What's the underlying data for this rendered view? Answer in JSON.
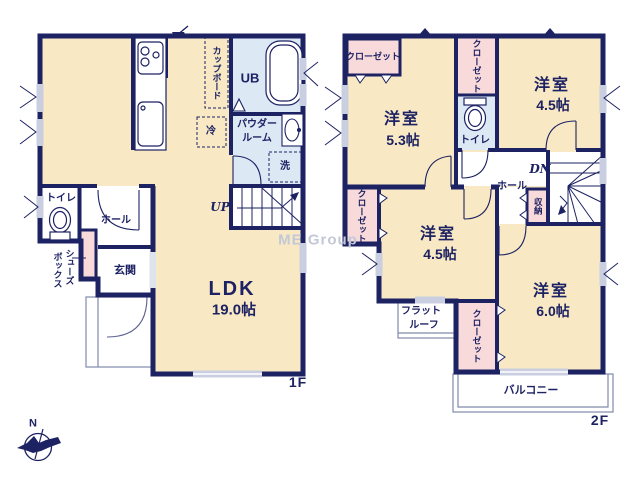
{
  "watermark": "ME Group",
  "compass": {
    "north": "N"
  },
  "colors": {
    "wall": "#1d2263",
    "room_cream": "#f8e8c4",
    "closet_pink": "#f8dada",
    "wet_blue": "#dce8f4",
    "window_gray": "#c9cfe0",
    "outline_gray": "#8289ab"
  },
  "floor1": {
    "label": "1F",
    "ldk": {
      "name": "LDK",
      "size": "19.0帖"
    },
    "cupboard": "カップボード",
    "fridge": "冷",
    "unit_bath": "UB",
    "powder_room": {
      "line1": "パウダー",
      "line2": "ルーム"
    },
    "washer": "洗",
    "stairs": "UP",
    "toilet": "トイレ",
    "hall": "ホール",
    "entrance": "玄関",
    "shoe_box": {
      "line1": "シューズ",
      "line2": "ボックス"
    }
  },
  "floor2": {
    "label": "2F",
    "bedroom_nw": {
      "name": "洋室",
      "size": "5.3帖"
    },
    "bedroom_ne": {
      "name": "洋室",
      "size": "4.5帖"
    },
    "bedroom_sw": {
      "name": "洋室",
      "size": "4.5帖"
    },
    "bedroom_se": {
      "name": "洋室",
      "size": "6.0帖"
    },
    "closet_nw": "クローゼット",
    "closet_mid": "クローゼット",
    "closet_sw": "クローゼット",
    "closet_se": "クローゼット",
    "toilet": "トイレ",
    "hall": "ホール",
    "storage": "収納",
    "stairs": "DN",
    "flat_roof": {
      "line1": "フラット",
      "line2": "ルーフ"
    },
    "balcony": "バルコニー"
  }
}
